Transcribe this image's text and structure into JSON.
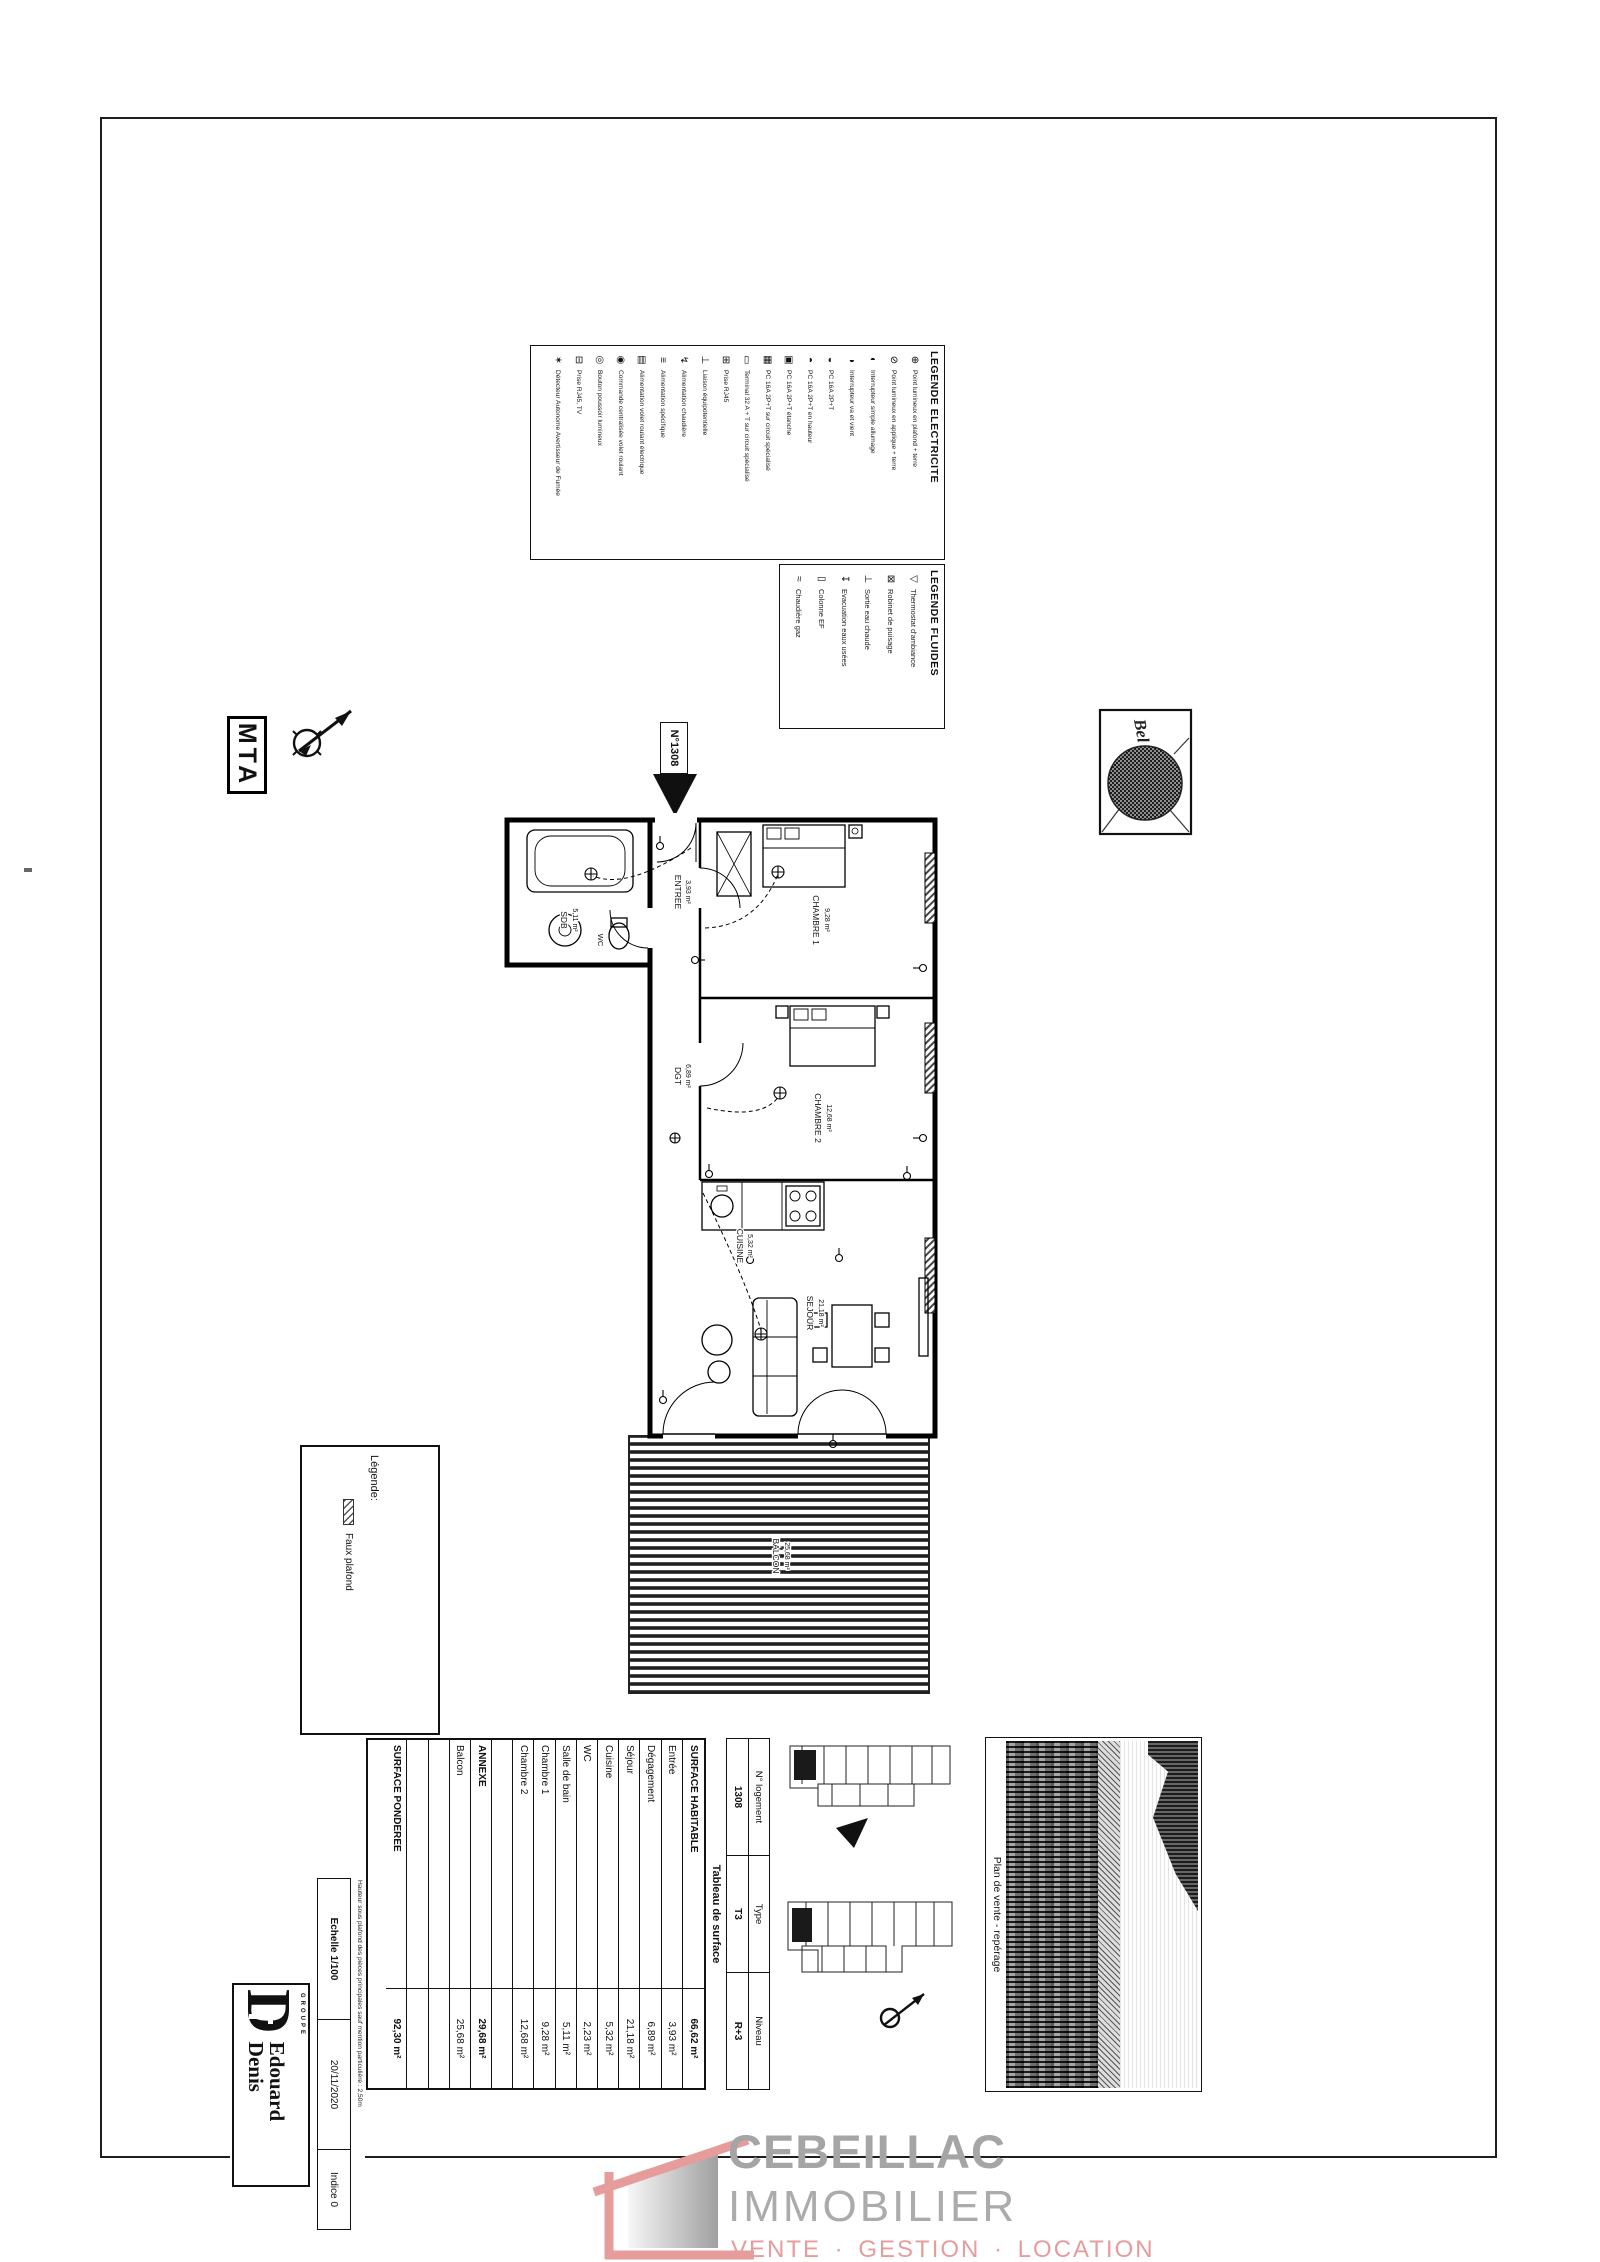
{
  "colors": {
    "watermark_gray": "#a5a5a5",
    "watermark_pink": "#e79c9c",
    "ink": "#111111"
  },
  "legend_electricite": {
    "title": "LEGENDE ELECTRICITE",
    "items": [
      {
        "sym": "⊕",
        "label": "Point lumineux en plafond + terre"
      },
      {
        "sym": "⊘",
        "label": "Point lumineux en applique + terre"
      },
      {
        "sym": "◐",
        "label": "Interrupteur simple allumage"
      },
      {
        "sym": "◑",
        "label": "Interrupteur va et vient"
      },
      {
        "sym": "◒",
        "label": "PC 16A 2P+T"
      },
      {
        "sym": "◓",
        "label": "PC 16A 2P+T en hauteur"
      },
      {
        "sym": "▣",
        "label": "PC 16A 2P+T étanche"
      },
      {
        "sym": "▦",
        "label": "PC 16A 2P+T sur circuit spécialisé"
      },
      {
        "sym": "▭",
        "label": "Terminal 32 A + T sur circuit spécialisé"
      },
      {
        "sym": "⊞",
        "label": "Prise RJ45"
      },
      {
        "sym": "⊥",
        "label": "Liaison équipotentielle"
      },
      {
        "sym": "↯",
        "label": "Alimentation chaudière"
      },
      {
        "sym": "≡",
        "label": "Alimentation spécifique"
      },
      {
        "sym": "▤",
        "label": "Alimentation volet roulant électrique"
      },
      {
        "sym": "◉",
        "label": "Commande centralisée volet roulant"
      },
      {
        "sym": "◎",
        "label": "Bouton poussoir lumineux"
      },
      {
        "sym": "⊟",
        "label": "Prise RJ45, TV"
      },
      {
        "sym": "✶",
        "label": "Détecteur Autonome Avertisseur de Fumée"
      }
    ]
  },
  "legend_fluides": {
    "title": "LEGENDE FLUIDES",
    "items": [
      {
        "sym": "▽",
        "label": "Thermostat d'ambiance"
      },
      {
        "sym": "⊠",
        "label": "Robinet de puisage"
      },
      {
        "sym": "⊥",
        "label": "Sortie eau chaude"
      },
      {
        "sym": "↧",
        "label": "Evacuation eaux usées"
      },
      {
        "sym": "▯",
        "label": "Colonne EF"
      },
      {
        "sym": "≈",
        "label": "Chaudière gaz"
      }
    ]
  },
  "mta_logo": "MTA",
  "unit_label": "N°1308",
  "stamp": {
    "text": "Bel"
  },
  "plan": {
    "rooms": [
      {
        "name": "SDB",
        "area": "5,11 m²"
      },
      {
        "name": "WC",
        "area": "2,23 m²"
      },
      {
        "name": "ENTREE",
        "area": "3,93 m²"
      },
      {
        "name": "DGT",
        "area": "6,89 m²"
      },
      {
        "name": "CHAMBRE 1",
        "area": "9,28 m²"
      },
      {
        "name": "CHAMBRE 2",
        "area": "12,68 m²"
      },
      {
        "name": "CUISINE",
        "area": "5,32 m²"
      },
      {
        "name": "SEJOUR",
        "area": "21,18 m²"
      },
      {
        "name": "BALCON",
        "area": "25,68 m²"
      }
    ]
  },
  "faux_plafond": {
    "label": "Légende:",
    "item": "Faux plafond"
  },
  "title_block": {
    "info": {
      "h1": "N° logement",
      "h2": "Type",
      "h3": "Niveau",
      "v1": "1308",
      "v2": "T3",
      "v3": "R+3"
    },
    "table_title": "Tableau de surface",
    "rows": [
      {
        "label": "SURFACE HABITABLE",
        "value": "66,62 m²"
      },
      {
        "label": "Entrée",
        "value": "3,93 m²"
      },
      {
        "label": "Dégagement",
        "value": "6,89 m²"
      },
      {
        "label": "Séjour",
        "value": "21,18 m²"
      },
      {
        "label": "Cuisine",
        "value": "5,32 m²"
      },
      {
        "label": "WC",
        "value": "2,23 m²"
      },
      {
        "label": "Salle de bain",
        "value": "5,11 m²"
      },
      {
        "label": "Chambre 1",
        "value": "9,28 m²"
      },
      {
        "label": "Chambre 2",
        "value": "12,68 m²"
      },
      {
        "label": "",
        "value": ""
      },
      {
        "label": "ANNEXE",
        "value": "29,68 m²"
      },
      {
        "label": "Balcon",
        "value": "25,68 m²"
      },
      {
        "label": "",
        "value": ""
      },
      {
        "label": "",
        "value": ""
      },
      {
        "label": "SURFACE PONDEREE",
        "value": "92,30 m²"
      }
    ],
    "echelle": "Echelle 1/100",
    "date": "20/11/2020",
    "indice": "Indice 0",
    "fine_print": "Hauteur sous plafond des pièces principales sauf mention particulière : 2,50m",
    "logo": {
      "groupe": "GROUPE",
      "d": "D",
      "name1": "Edouard",
      "name2": "Denis"
    },
    "reperage_title": "Plan de vente - repérage"
  },
  "watermark": {
    "brand": "CEBEILLAC",
    "brand2": "IMMOBILIER",
    "tagline": "VENTE · GESTION · LOCATION"
  }
}
